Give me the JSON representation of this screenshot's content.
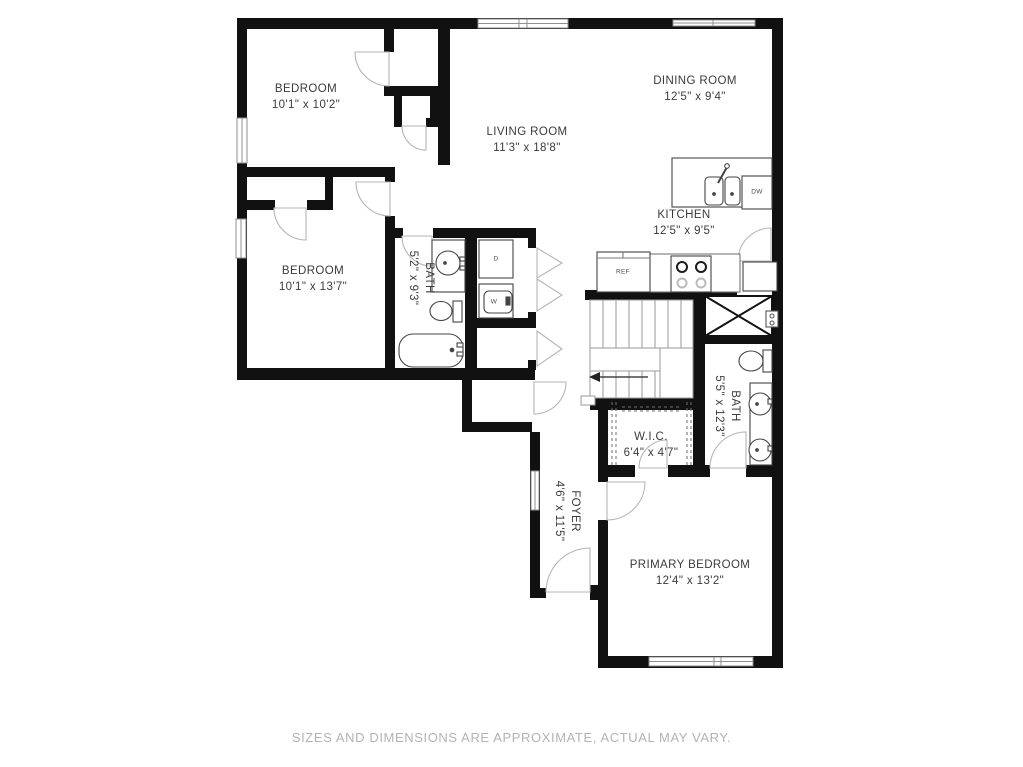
{
  "footer": {
    "disclaimer": "SIZES AND DIMENSIONS ARE APPROXIMATE, ACTUAL MAY VARY."
  },
  "colors": {
    "wall": "#111111",
    "door_swing": "#b5b5b5",
    "fixture_line": "#444444",
    "stair_line": "#9a9a9a",
    "window_frame": "#8f8f8f",
    "label_text": "#3b3b3b",
    "footer_text": "#b3b3b3",
    "background": "#ffffff"
  },
  "rooms": {
    "bedroom1": {
      "name": "BEDROOM",
      "dims": "10'1\" x 10'2\""
    },
    "dining": {
      "name": "DINING ROOM",
      "dims": "12'5\" x 9'4\""
    },
    "living": {
      "name": "LIVING ROOM",
      "dims": "11'3\" x 18'8\""
    },
    "kitchen": {
      "name": "KITCHEN",
      "dims": "12'5\" x 9'5\""
    },
    "bedroom2": {
      "name": "BEDROOM",
      "dims": "10'1\" x 13'7\""
    },
    "bath1": {
      "name": "BATH",
      "dims": "5'2\" x 9'3\""
    },
    "bath2": {
      "name": "BATH",
      "dims": "5'5\" x 12'3\""
    },
    "wic": {
      "name": "W.I.C.",
      "dims": "6'4\" x 4'7\""
    },
    "foyer": {
      "name": "FOYER",
      "dims": "4'6\" x 11'5\""
    },
    "primary": {
      "name": "PRIMARY BEDROOM",
      "dims": "12'4\" x 13'2\""
    }
  },
  "appliances": {
    "refrigerator": "REF",
    "dishwasher": "DW",
    "dryer": "D",
    "washer": "W"
  }
}
